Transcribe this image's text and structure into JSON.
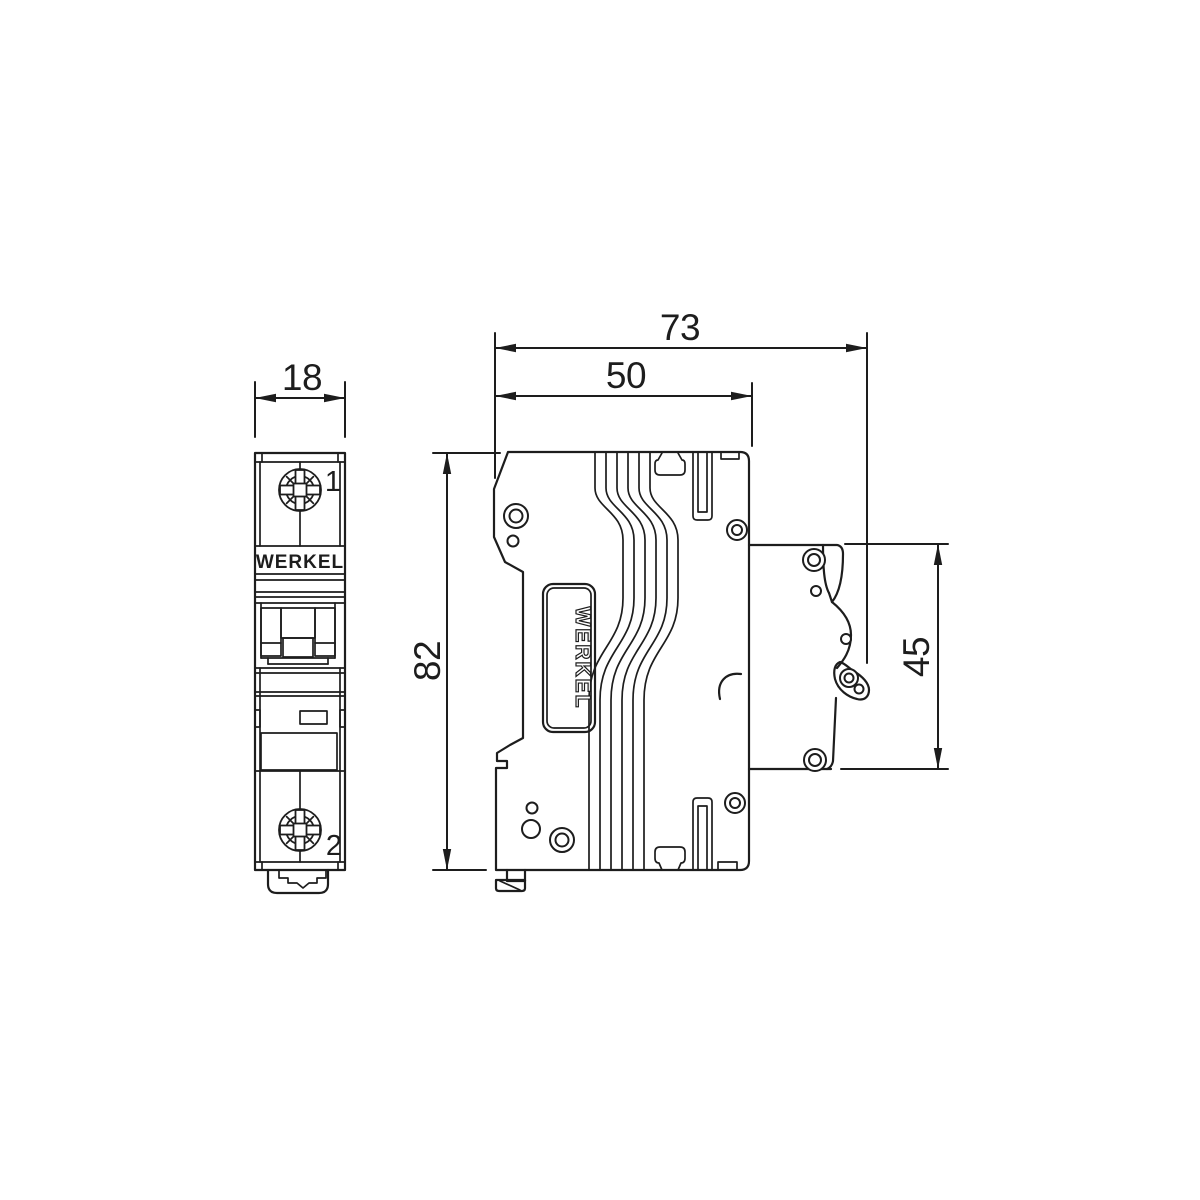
{
  "drawing": {
    "brand": "WERKEL",
    "type": "circuit-breaker-dimension-drawing",
    "dims": {
      "front_width": "18",
      "overall_depth": "73",
      "body_depth": "50",
      "height": "82",
      "din_height": "45"
    },
    "terminals": {
      "top": "1",
      "bottom": "2"
    }
  },
  "colors": {
    "line": "#1d1d1d",
    "background": "#ffffff"
  }
}
